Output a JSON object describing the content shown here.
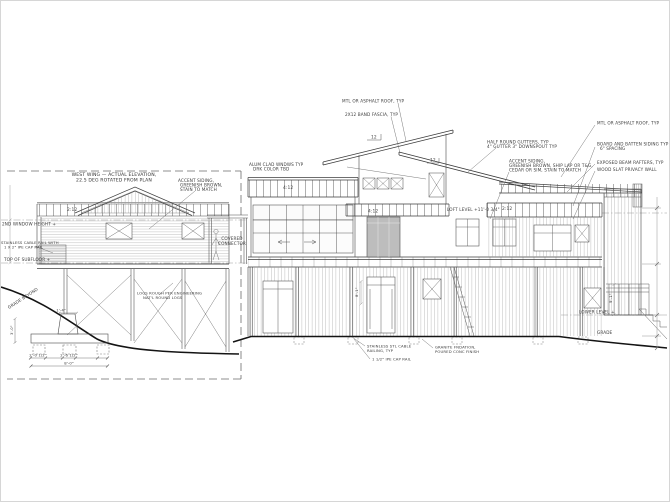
{
  "title": {
    "l1": "WEST WING — ACTUAL ELEVATION,",
    "l2": "22.5 DEG ROTATED FROM PLAN"
  },
  "datum": {
    "window_height": "2ND WINDOW HEIGHT +",
    "subfloor": "TOP OF SUBFLOOR +",
    "loft": "LOFT LEVEL +11'-0 3/4\"",
    "lower": "LOWER LEVEL +",
    "grade": "GRADE",
    "grade_beyond": "GRADE BEYOND"
  },
  "pitch": {
    "west": "2:12",
    "left": "4:12",
    "tower": "4:12",
    "right": "2:12",
    "rise_a": "12",
    "rise_b": "12"
  },
  "connector": {
    "l1": "COVERED",
    "l2": "CONNECTOR"
  },
  "notes": {
    "roof_center": "MTL OR ASPHALT ROOF, TYP",
    "fascia": "2X12 BAND FASCIA, TYP",
    "clad1": "ALUM CLAD WNDWS TYP",
    "clad2": "DRK COLOR TBD",
    "gutters1": "HALF ROUND GUTTERS, TYP",
    "gutters2": "4\" GUTTER 3\" DOWNSPOUT TYP",
    "siding1": "ACCENT SIDING,",
    "siding2": "GREENISH BROWN, SHIP LAP OR T&G,",
    "siding3": "CEDAR OR SIM, STAIN TO MATCH",
    "accent1": "ACCENT SIDING,",
    "accent2": "GREENISH BROWN,",
    "accent3": "STAIN TO MATCH",
    "roof_right": "MTL OR ASPHALT ROOF, TYP",
    "bnb1": "BOARD AND BATTEN SIDING TYP",
    "bnb2": "6\" SPACING",
    "rafters": "EXPOSED BEAM RAFTERS, TYP",
    "privacy": "WOOD SLAT PRIVACY WALL",
    "rail1": "STAINLESS STL CABLE",
    "rail2": "RAILING, TYP",
    "ipe": "1 1/2\" IPE CAP RAIL",
    "granite1": "GRANITE FNDATION,",
    "granite2": "POURED CONC FINISH",
    "cable1": "STAINLESS CABLE RAIL WITH",
    "cable2": "1 X 2\" IPE CAP RAIL",
    "logs1": "LOGS ROUGH PER ENGINEERING",
    "logs2": "NAT'L ROUND LOGS"
  },
  "dims": {
    "pier": "1'-4\"",
    "f1": "2'-0 1/2\"",
    "f2": "2'-6 1/2\"",
    "overall": "8'-0\"",
    "depth": "3'-0\"",
    "post": "8'-1\"",
    "right": "9'-1\""
  }
}
